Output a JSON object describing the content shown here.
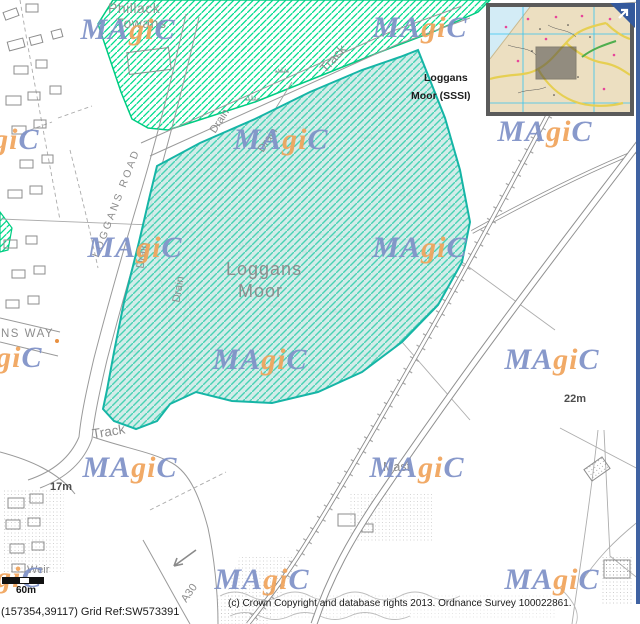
{
  "magic_logo": {
    "part_ma": "MA",
    "part_gi": "gi",
    "part_c": "C",
    "blue": "#8092c8",
    "orange": "#f0a45c"
  },
  "watermark_positions": [
    {
      "x": 128,
      "y": 30
    },
    {
      "x": 420,
      "y": 28
    },
    {
      "x": -8,
      "y": 140
    },
    {
      "x": 281,
      "y": 140
    },
    {
      "x": 545,
      "y": 132
    },
    {
      "x": 135,
      "y": 248
    },
    {
      "x": 420,
      "y": 248
    },
    {
      "x": -5,
      "y": 358
    },
    {
      "x": 260,
      "y": 360
    },
    {
      "x": 552,
      "y": 360
    },
    {
      "x": 130,
      "y": 468
    },
    {
      "x": 417,
      "y": 468
    },
    {
      "x": -5,
      "y": 578
    },
    {
      "x": 262,
      "y": 580
    },
    {
      "x": 552,
      "y": 580
    }
  ],
  "labels": [
    {
      "id": "phillack-towans-1",
      "text": "Phillack",
      "x": 108,
      "y": 1,
      "size": 14,
      "color": "#8f948f",
      "ls": 0.5
    },
    {
      "id": "phillack-towans-2",
      "text": "Towans",
      "x": 116,
      "y": 16,
      "size": 14,
      "color": "#8f948f",
      "ls": 0.5
    },
    {
      "id": "sssi-label-1",
      "text": "Loggans",
      "x": 424,
      "y": 73,
      "size": 10.5,
      "color": "#1c1c1c",
      "bold": true
    },
    {
      "id": "sssi-label-2",
      "text": "Moor (SSSI)",
      "x": 411,
      "y": 91,
      "size": 10.5,
      "color": "#1c1c1c",
      "bold": true
    },
    {
      "id": "loggans-moor-1",
      "text": "Loggans",
      "x": 226,
      "y": 260,
      "size": 18,
      "ls": 1
    },
    {
      "id": "loggans-moor-2",
      "text": "Moor",
      "x": 238,
      "y": 282,
      "size": 18,
      "ls": 1
    },
    {
      "id": "track-north",
      "text": "Track",
      "x": 317,
      "y": 52,
      "size": 13,
      "rot": -48
    },
    {
      "id": "track-south",
      "text": "Track",
      "x": 92,
      "y": 425,
      "size": 13.5,
      "rot": -9
    },
    {
      "id": "drain-1",
      "text": "Drain",
      "x": 207,
      "y": 116,
      "size": 11,
      "rot": -57
    },
    {
      "id": "drain-2",
      "text": "Drain",
      "x": 255,
      "y": 135,
      "size": 11,
      "rot": -57
    },
    {
      "id": "drain-3",
      "text": "Drain",
      "x": 130,
      "y": 250,
      "size": 11,
      "rot": -80
    },
    {
      "id": "drain-4",
      "text": "Drain",
      "x": 166,
      "y": 284,
      "size": 11,
      "rot": -80
    },
    {
      "id": "loggans-road",
      "text": "LOGGANS ROAD",
      "x": 59,
      "y": 198,
      "size": 10.5,
      "rot": -69,
      "ls": 2.5
    },
    {
      "id": "ns-way",
      "text": "NS WAY",
      "x": 1,
      "y": 329,
      "size": 11.5,
      "ls": 1.5
    },
    {
      "id": "mast",
      "text": "Mast",
      "x": 383,
      "y": 461,
      "size": 12.5
    },
    {
      "id": "spot-height-22m",
      "text": "22m",
      "x": 564,
      "y": 394,
      "size": 11,
      "bold": true,
      "color": "#4d4d4d"
    },
    {
      "id": "spot-height-17m",
      "text": "17m",
      "x": 50,
      "y": 482,
      "size": 11,
      "bold": true,
      "color": "#4d4d4d"
    },
    {
      "id": "a30-label",
      "text": "A30",
      "x": 180,
      "y": 588,
      "size": 11,
      "rot": -55
    },
    {
      "id": "weir",
      "text": "Weir",
      "x": 27,
      "y": 565,
      "size": 11
    }
  ],
  "scale_bar": {
    "label": "60m"
  },
  "footer": {
    "grid_ref": "(157354,39117) Grid Ref:SW573391",
    "copyright": "(c) Crown Copyright and database rights 2013. Ordnance Survey 100022861."
  },
  "overlay_colors": {
    "sssi_fill": "#cde9e5",
    "sssi_hatch": "#49d2b4",
    "sssi_border": "#16b5a6",
    "towans_hatch": "#00dc8c",
    "towans_border": "#00cc82"
  }
}
